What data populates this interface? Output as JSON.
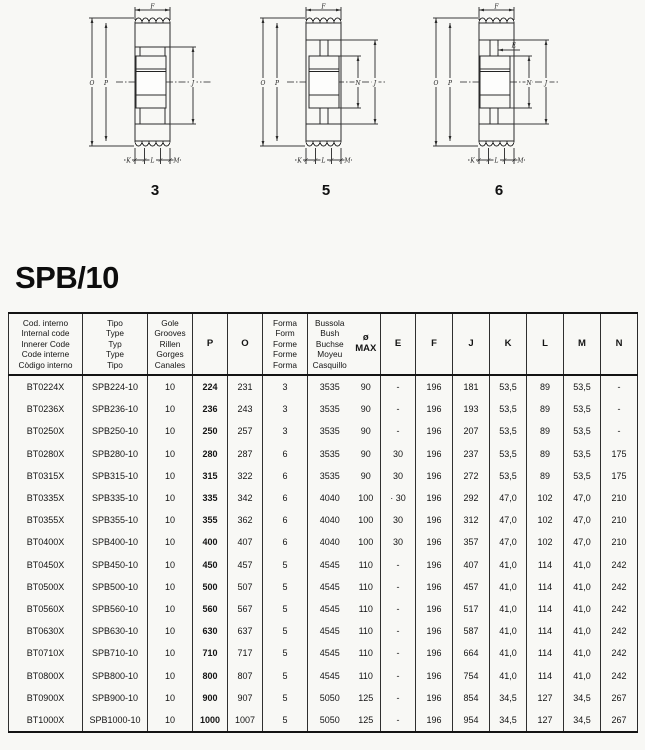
{
  "page": {
    "title": "SPB/10",
    "background": "#f8f8f5",
    "ink": "#141414"
  },
  "diagrams": [
    {
      "number": "3",
      "dims": {
        "F": "F",
        "O": "O",
        "P": "P",
        "J": "J",
        "K": "K",
        "L": "L",
        "M": "M"
      }
    },
    {
      "number": "5",
      "dims": {
        "F": "F",
        "O": "O",
        "P": "P",
        "N": "N",
        "J": "J",
        "K": "K",
        "L": "L",
        "M": "M"
      }
    },
    {
      "number": "6",
      "dims": {
        "F": "F",
        "E": "E",
        "O": "O",
        "P": "P",
        "N": "N",
        "J": "J",
        "K": "K",
        "L": "L",
        "M": "M"
      }
    }
  ],
  "table": {
    "columns": [
      {
        "id": "code",
        "lines": [
          "Cod. interno",
          "Internal code",
          "Innerer Code",
          "Code interne",
          "Còdigo interno"
        ]
      },
      {
        "id": "type",
        "lines": [
          "Tipo",
          "Type",
          "Typ",
          "Type",
          "Tipo"
        ]
      },
      {
        "id": "grooves",
        "lines": [
          "Gole",
          "Grooves",
          "Rillen",
          "Gorges",
          "Canales"
        ]
      },
      {
        "id": "p",
        "lines": [
          "P"
        ],
        "bold": true
      },
      {
        "id": "o",
        "lines": [
          "O"
        ],
        "bold": true
      },
      {
        "id": "form",
        "lines": [
          "Forma",
          "Form",
          "Forme",
          "Forme",
          "Forma"
        ]
      },
      {
        "id": "bush",
        "lines": [
          "Bussola",
          "Bush",
          "Buchse",
          "Moyeu",
          "Casquillo"
        ]
      },
      {
        "id": "max",
        "lines": [
          "ø",
          "MAX"
        ],
        "bold": true
      },
      {
        "id": "e",
        "lines": [
          "E"
        ],
        "bold": true
      },
      {
        "id": "f",
        "lines": [
          "F"
        ],
        "bold": true
      },
      {
        "id": "j",
        "lines": [
          "J"
        ],
        "bold": true
      },
      {
        "id": "k",
        "lines": [
          "K"
        ],
        "bold": true
      },
      {
        "id": "l",
        "lines": [
          "L"
        ],
        "bold": true
      },
      {
        "id": "m",
        "lines": [
          "M"
        ],
        "bold": true
      },
      {
        "id": "n",
        "lines": [
          "N"
        ],
        "bold": true
      }
    ],
    "rows": [
      [
        "BT0224X",
        "SPB224-10",
        "10",
        "224",
        "231",
        "3",
        "3535",
        "90",
        "-",
        "196",
        "181",
        "53,5",
        "89",
        "53,5",
        "-"
      ],
      [
        "BT0236X",
        "SPB236-10",
        "10",
        "236",
        "243",
        "3",
        "3535",
        "90",
        "-",
        "196",
        "193",
        "53,5",
        "89",
        "53,5",
        "-"
      ],
      [
        "BT0250X",
        "SPB250-10",
        "10",
        "250",
        "257",
        "3",
        "3535",
        "90",
        "-",
        "196",
        "207",
        "53,5",
        "89",
        "53,5",
        "-"
      ],
      [
        "BT0280X",
        "SPB280-10",
        "10",
        "280",
        "287",
        "6",
        "3535",
        "90",
        "30",
        "196",
        "237",
        "53,5",
        "89",
        "53,5",
        "175"
      ],
      [
        "BT0315X",
        "SPB315-10",
        "10",
        "315",
        "322",
        "6",
        "3535",
        "90",
        "30",
        "196",
        "272",
        "53,5",
        "89",
        "53,5",
        "175"
      ],
      [
        "BT0335X",
        "SPB335-10",
        "10",
        "335",
        "342",
        "6",
        "4040",
        "100",
        "· 30",
        "196",
        "292",
        "47,0",
        "102",
        "47,0",
        "210"
      ],
      [
        "BT0355X",
        "SPB355-10",
        "10",
        "355",
        "362",
        "6",
        "4040",
        "100",
        "30",
        "196",
        "312",
        "47,0",
        "102",
        "47,0",
        "210"
      ],
      [
        "BT0400X",
        "SPB400-10",
        "10",
        "400",
        "407",
        "6",
        "4040",
        "100",
        "30",
        "196",
        "357",
        "47,0",
        "102",
        "47,0",
        "210"
      ],
      [
        "BT0450X",
        "SPB450-10",
        "10",
        "450",
        "457",
        "5",
        "4545",
        "110",
        "-",
        "196",
        "407",
        "41,0",
        "114",
        "41,0",
        "242"
      ],
      [
        "BT0500X",
        "SPB500-10",
        "10",
        "500",
        "507",
        "5",
        "4545",
        "110",
        "-",
        "196",
        "457",
        "41,0",
        "114",
        "41,0",
        "242"
      ],
      [
        "BT0560X",
        "SPB560-10",
        "10",
        "560",
        "567",
        "5",
        "4545",
        "110",
        "-",
        "196",
        "517",
        "41,0",
        "114",
        "41,0",
        "242"
      ],
      [
        "BT0630X",
        "SPB630-10",
        "10",
        "630",
        "637",
        "5",
        "4545",
        "110",
        "-",
        "196",
        "587",
        "41,0",
        "114",
        "41,0",
        "242"
      ],
      [
        "BT0710X",
        "SPB710-10",
        "10",
        "710",
        "717",
        "5",
        "4545",
        "110",
        "-",
        "196",
        "664",
        "41,0",
        "114",
        "41,0",
        "242"
      ],
      [
        "BT0800X",
        "SPB800-10",
        "10",
        "800",
        "807",
        "5",
        "4545",
        "110",
        "-",
        "196",
        "754",
        "41,0",
        "114",
        "41,0",
        "242"
      ],
      [
        "BT0900X",
        "SPB900-10",
        "10",
        "900",
        "907",
        "5",
        "5050",
        "125",
        "-",
        "196",
        "854",
        "34,5",
        "127",
        "34,5",
        "267"
      ],
      [
        "BT1000X",
        "SPB1000-10",
        "10",
        "1000",
        "1007",
        "5",
        "5050",
        "125",
        "-",
        "196",
        "954",
        "34,5",
        "127",
        "34,5",
        "267"
      ]
    ]
  }
}
